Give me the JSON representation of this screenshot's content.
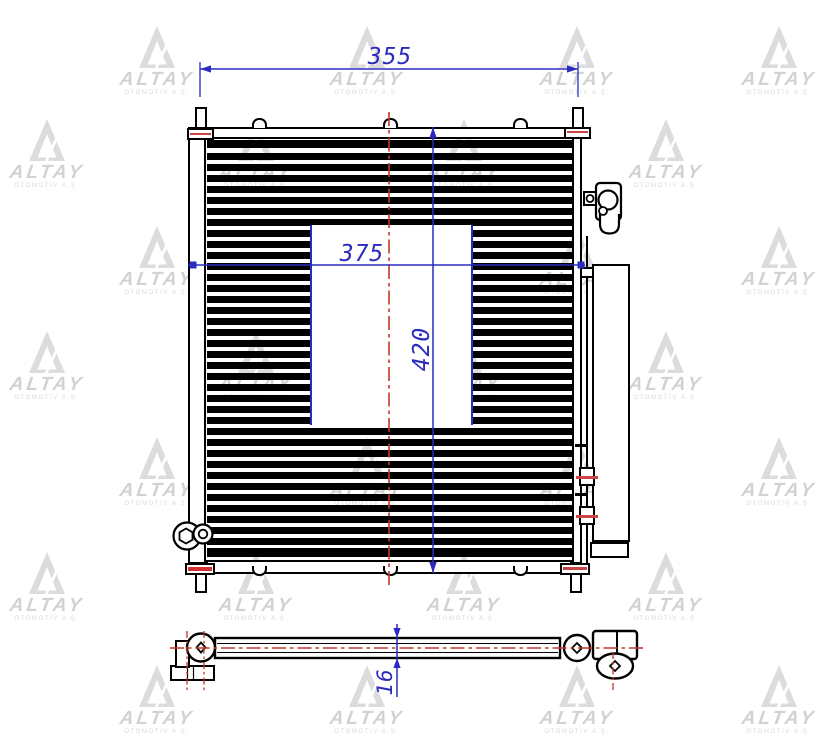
{
  "watermark": {
    "brand": "ALTAY",
    "subtitle": "OTOMOTİV A.Ş."
  },
  "dims": {
    "top_width": "355",
    "core_width": "375",
    "core_height": "420",
    "thickness": "16"
  },
  "colors": {
    "dimension_blue": "#2b2bc0",
    "centerline_red": "#c0392b",
    "accent_red": "#cc4444",
    "line_black": "#000000",
    "watermark_gray": "#dcdcdc"
  }
}
